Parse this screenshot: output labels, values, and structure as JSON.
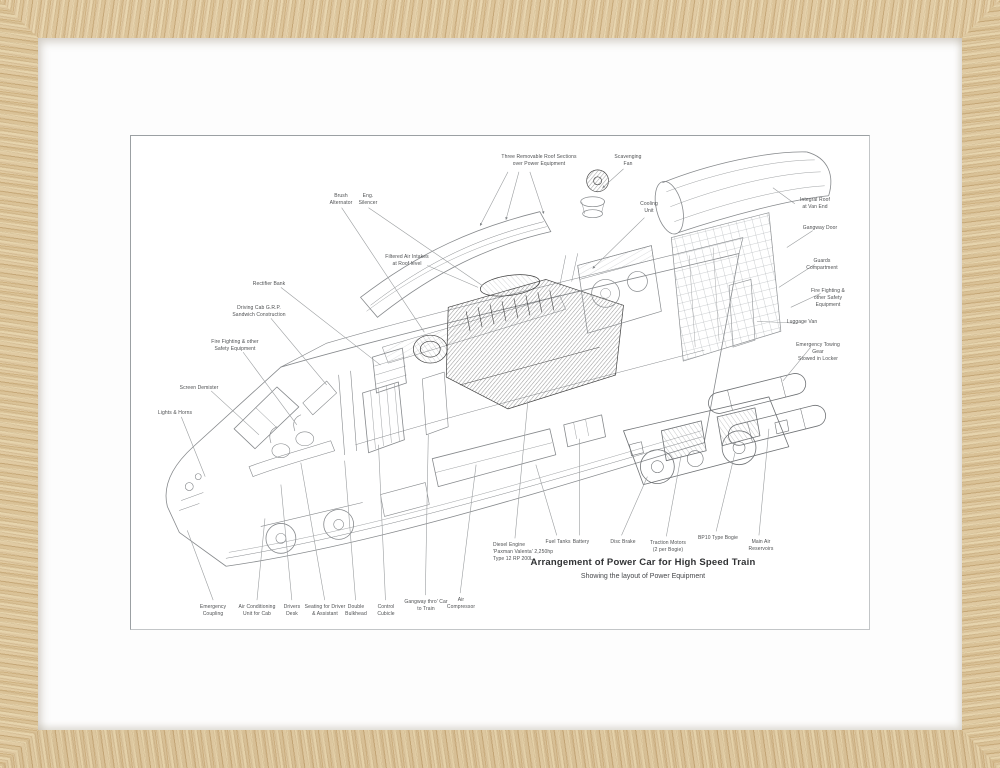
{
  "artwork": {
    "title": "Arrangement of Power Car for High Speed Train",
    "subtitle": "Showing the layout of Power Equipment"
  },
  "labels": {
    "roof_sections": "Three Removable Roof Sections\nover Power Equipment",
    "scavenging_fan": "Scavenging\nFan",
    "cooling_unit": "Cooling\nUnit",
    "brush_alternator": "Brush\nAlternator",
    "eng_silencer": "Eng.\nSilencer",
    "filtered_air_intakes": "Filtered Air Intakes\nat Roof level",
    "rectifier_bank": "Rectifier Bank",
    "driving_cab": "Driving Cab G.R.P.\nSandwich Construction",
    "fire_fighting_left": "Fire Fighting & other\nSafety Equipment",
    "screen_demister": "Screen Demister",
    "lights_horns": "Lights & Horns",
    "emergency_coupling": "Emergency\nCoupling",
    "air_conditioning": "Air Conditioning\nUnit for Cab",
    "drivers_desk": "Drivers\nDesk",
    "seating": "Seating for Driver\n& Assistant",
    "double_bulkhead": "Double\nBulkhead",
    "control_cubicle": "Control\nCubicle",
    "gangway": "Gangway thro' Car\nto Train",
    "air_compressor": "Air\nCompressor",
    "diesel_engine": "Diesel Engine\n'Paxman Valenta' 2,250hp\nType 12 RP 200L",
    "fuel_tanks": "Fuel Tanks",
    "battery": "Battery",
    "disc_brake": "Disc Brake",
    "traction_motors": "Traction Motors\n(2 per Bogie)",
    "bp10_bogie": "BP10 Type Bogie",
    "main_air_reservoirs": "Main Air\nReservoirs",
    "integral_roof": "Integral Roof\nat Van End",
    "gangway_door": "Gangway Door",
    "guards_compartment": "Guards\nCompartment",
    "fire_fighting_right": "Fire Fighting &\nother Safety Equipment",
    "luggage_van": "Luggage Van",
    "emergency_towing": "Emergency Towing Gear\nStowed in Locker"
  },
  "colors": {
    "frame_wood": "#d9c096",
    "mat": "#fdfdfd",
    "print_ink": "#4d4f51"
  }
}
